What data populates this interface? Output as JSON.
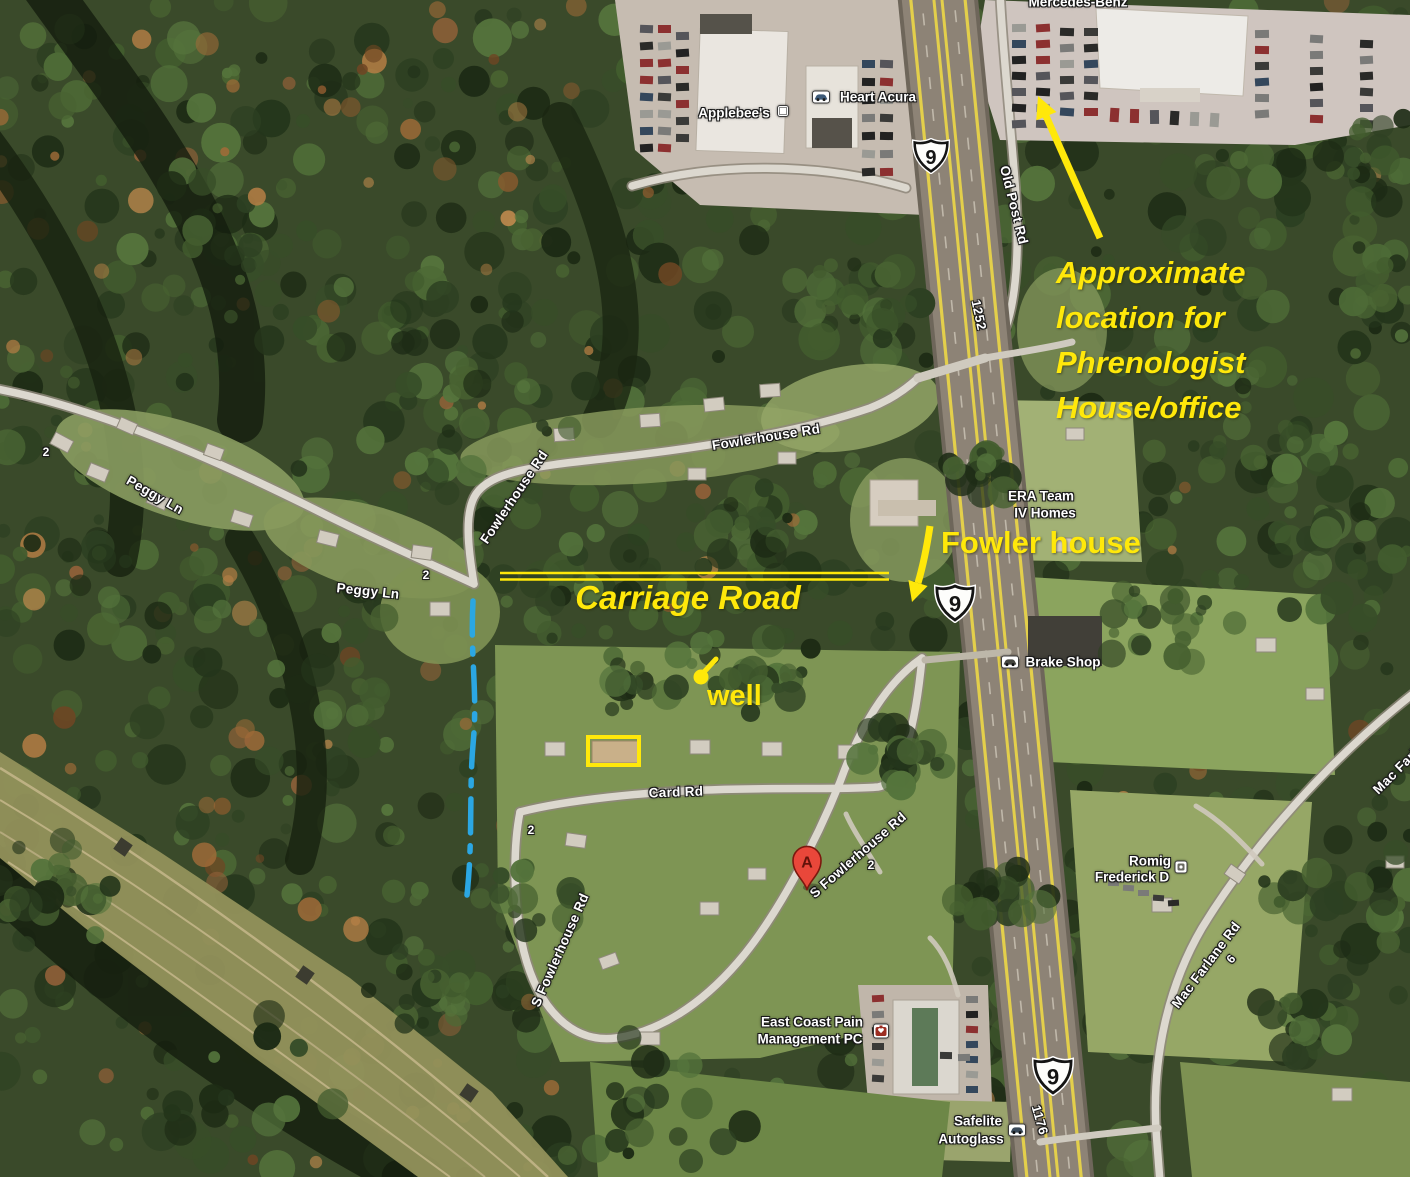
{
  "colors": {
    "annotation_yellow": "#ffe80a",
    "path_blue": "#2ba7e3",
    "marker_red": "#e9473a",
    "highway_stripe": "#e3cf4b"
  },
  "annotations": {
    "phrenologist_lines": [
      "Approximate",
      "location for",
      "Phrenologist",
      "House/office"
    ],
    "fowler_house": "Fowler house",
    "carriage_road": "Carriage Road",
    "well": "well"
  },
  "road_labels": {
    "peggy_ln_1": "Peggy Ln",
    "peggy_ln_2": "Peggy Ln",
    "fowlerhouse_rd_1": "Fowlerhouse Rd",
    "fowlerhouse_rd_2": "Fowlerhouse Rd",
    "card_rd": "Card Rd",
    "s_fowlerhouse_rd_1": "S Fowlerhouse Rd",
    "s_fowlerhouse_rd_2": "S Fowlerhouse Rd",
    "old_post_rd": "Old Post Rd",
    "mac_farlane_rd": "Mac Farlane Rd",
    "mac_farlane_rd_edge": "Mac Farlane Rd"
  },
  "poi_labels": {
    "mercedes_benz": "Mercedes-Benz",
    "applebees": "Applebee's",
    "heart_acura": "Heart Acura",
    "era_team_line1": "ERA Team",
    "era_team_line2": "IV Homes",
    "brake_shop": "Brake Shop",
    "romig_line1": "Romig",
    "romig_line2": "Frederick D",
    "east_coast_line1": "East Coast Pain",
    "east_coast_line2": "Management PC",
    "safelite_line1": "Safelite",
    "safelite_line2": "Autoglass"
  },
  "route_shields": {
    "top": "9",
    "middle": "9",
    "bottom": "9"
  },
  "route_numbers": {
    "r1252": "1252",
    "r1176": "1176"
  },
  "waypoint_numbers": {
    "n2_peggy_west": "2",
    "n2_peggy_east": "2",
    "n2_card": "2",
    "n2_sfowler": "2",
    "n6_macfarlane": "6"
  },
  "marker": {
    "label": "A"
  }
}
